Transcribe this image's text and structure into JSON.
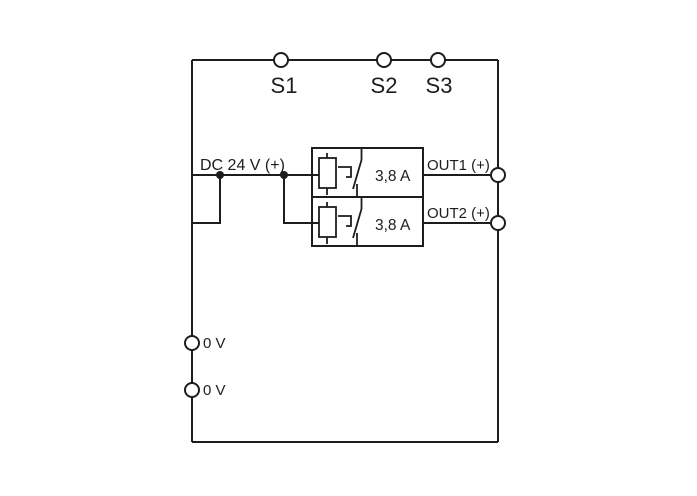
{
  "diagram": {
    "type": "wiring-diagram",
    "top_terminals": [
      {
        "label": "S1"
      },
      {
        "label": "S2"
      },
      {
        "label": "S3"
      }
    ],
    "input": {
      "label": "DC 24 V (+)"
    },
    "channels": [
      {
        "output_label": "OUT1 (+)",
        "rating": "3,8 A"
      },
      {
        "output_label": "OUT2 (+)",
        "rating": "3,8 A"
      }
    ],
    "zero_volt_terminals": [
      {
        "label": "0 V"
      },
      {
        "label": "0 V"
      }
    ],
    "colors": {
      "line": "#1d1d1b",
      "background": "#ffffff"
    }
  }
}
